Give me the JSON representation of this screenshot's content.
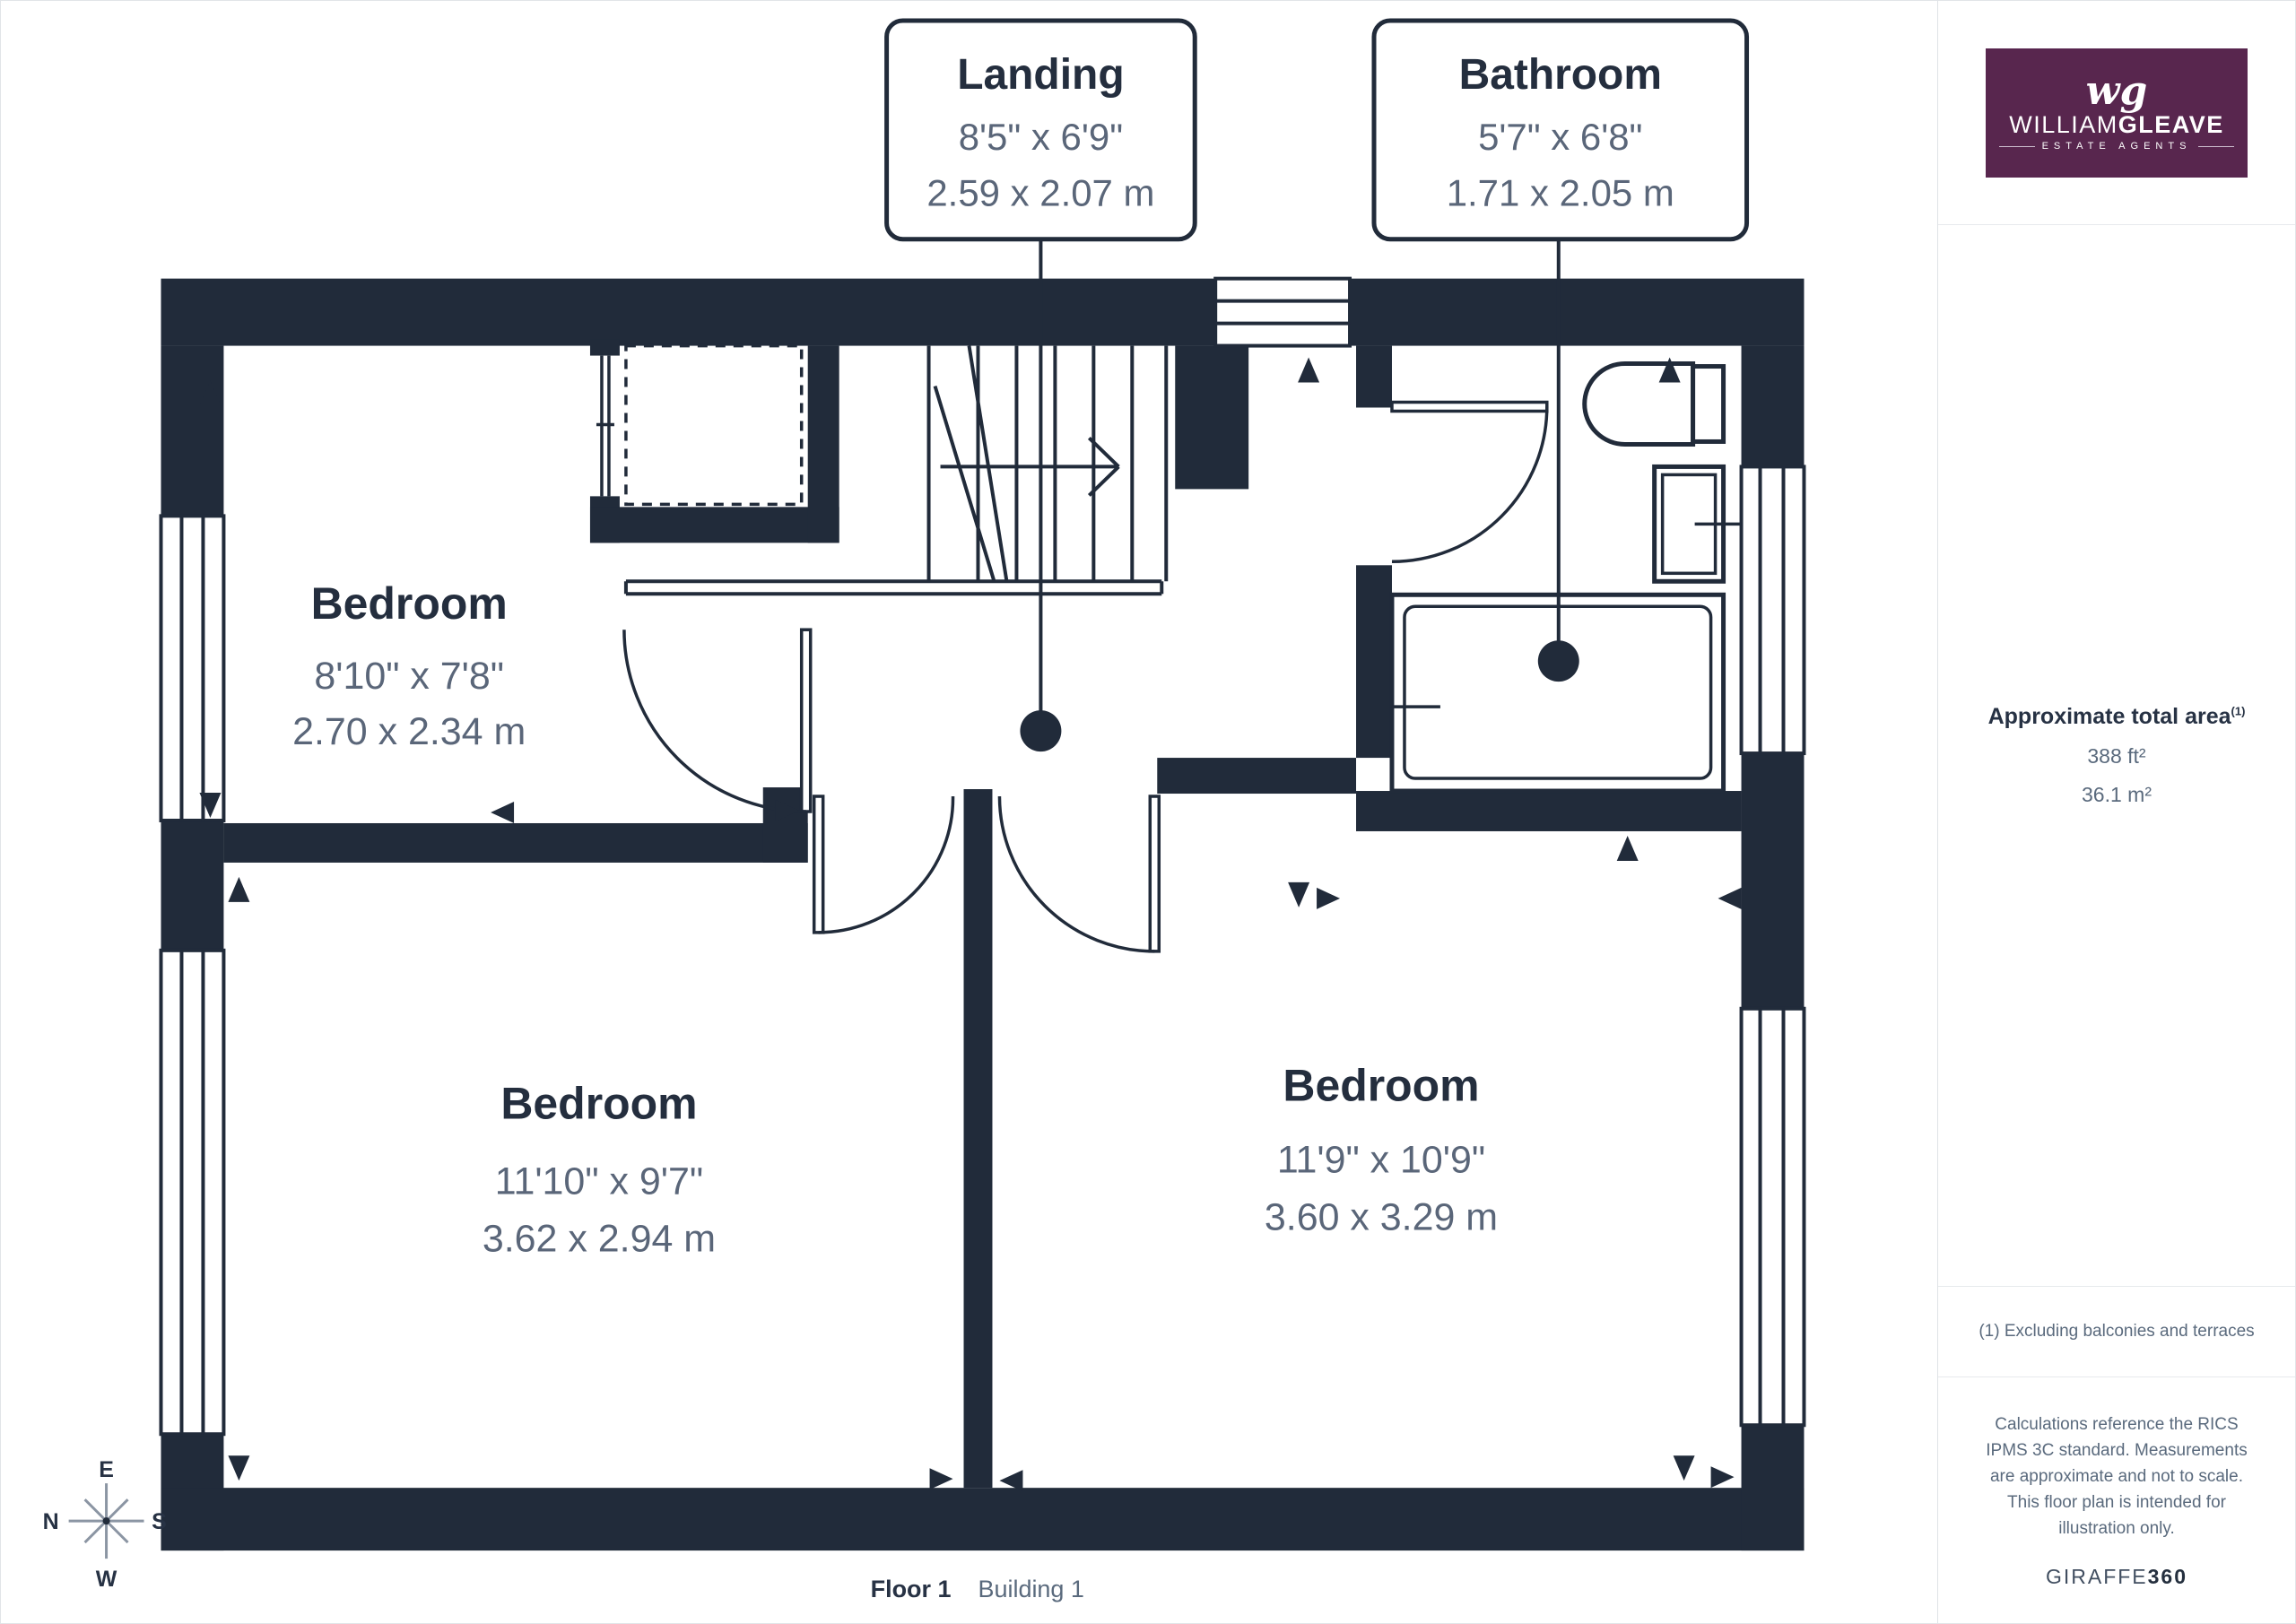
{
  "plan": {
    "callouts": [
      {
        "title": "Landing",
        "imperial": "8'5\" x 6'9\"",
        "metric": "2.59 x 2.07 m"
      },
      {
        "title": "Bathroom",
        "imperial": "5'7\" x 6'8\"",
        "metric": "1.71 x 2.05 m"
      }
    ],
    "rooms": [
      {
        "title": "Bedroom",
        "imperial": "8'10\" x 7'8\"",
        "metric": "2.70 x 2.34 m"
      },
      {
        "title": "Bedroom",
        "imperial": "11'10\" x 9'7\"",
        "metric": "3.62 x 2.94 m"
      },
      {
        "title": "Bedroom",
        "imperial": "11'9\" x 10'9\"",
        "metric": "3.60 x 3.29 m"
      }
    ],
    "compass": {
      "top": "E",
      "left": "N",
      "right": "S",
      "bottom": "W"
    },
    "floor_label": "Floor 1",
    "building_label": "Building 1"
  },
  "sidebar": {
    "logo": {
      "monogram": "wg",
      "name_light": "WILLIAM",
      "name_bold": "GLEAVE",
      "tagline": "ESTATE AGENTS"
    },
    "area": {
      "heading": "Approximate total area",
      "footnote_marker": "(1)",
      "imperial": "388 ft²",
      "metric": "36.1 m²"
    },
    "footnote": "(1) Excluding balconies and terraces",
    "disclaimer": "Calculations reference the RICS IPMS 3C standard. Measurements are approximate and not to scale. This floor plan is intended for illustration only.",
    "brand_footer_light": "GIRAFFE",
    "brand_footer_bold": "360"
  },
  "colors": {
    "wall": "#212b3a",
    "room_title": "#242e3e",
    "dimension_text": "#5a6679",
    "logo_background": "#58264e"
  }
}
